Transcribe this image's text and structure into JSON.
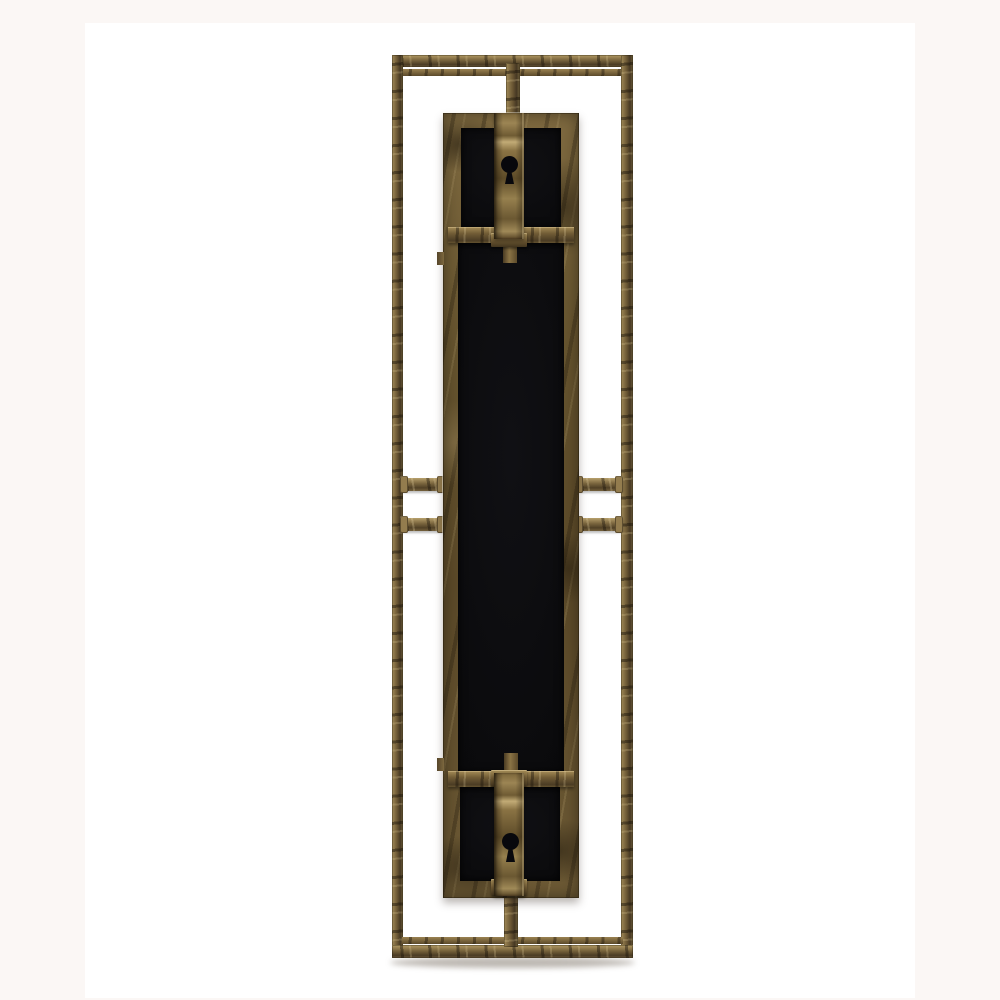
{
  "image": {
    "type": "product-photo",
    "subject": "Back view of a tall rectangular antique-bronze metal wall mirror frame on a white backdrop",
    "details": [
      "open rectangular outer frame made of slender square metal bar",
      "inner backing panel with black felt sections framed in distressed bronze",
      "keyhole hanger strap near the top with round keyhole slot",
      "keyhole hanger strap near the bottom with round keyhole slot",
      "horizontal cross bars across the panel above and below the black center",
      "two pairs of short side braces joining panel and frame at mid-height",
      "center straps joining panel to top and bottom frame rails",
      "soft drop shadow beneath the bottom rail"
    ]
  },
  "palette": {
    "page_background": "#fbf7f5",
    "photo_background": "#ffffff",
    "bronze_highlight": "#c2ab76",
    "bronze_mid": "#8a7344",
    "bronze_shadow": "#4a3b24",
    "bronze_deep": "#241c10",
    "panel_black": "#0b0b0d",
    "drop_shadow": "rgba(90,78,62,0.4)"
  },
  "theme": {
    "css_vars": "--page-bg:#fbf7f5;--photo-bg:#ffffff;--bz-hi:#c2ab76;--bz-mid:#8a7344;--bz-sh:#4a3b24;--bz-deep:#241c10;--ink:#0b0b0d;"
  }
}
